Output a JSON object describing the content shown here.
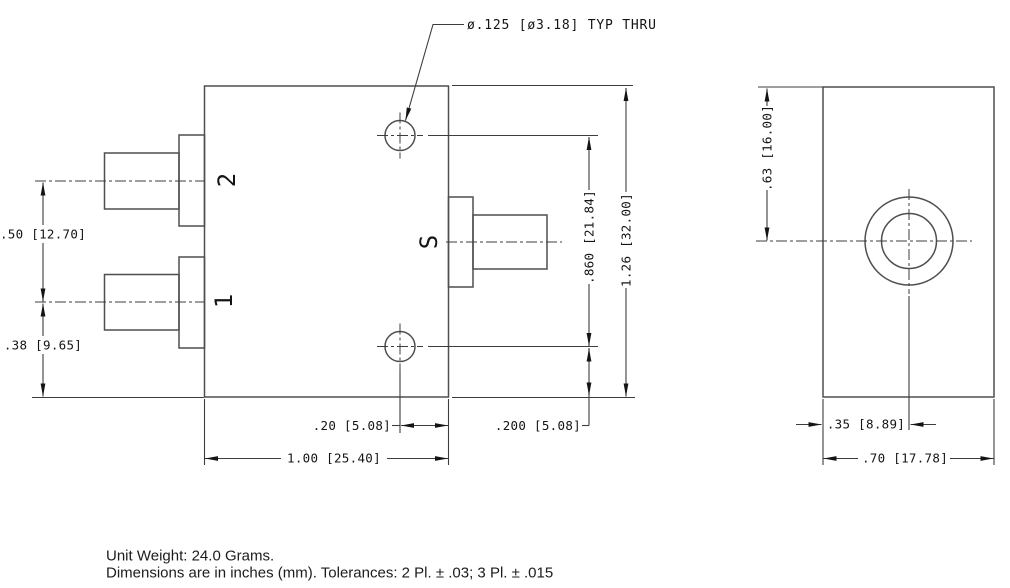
{
  "drawing": {
    "callout": "ø.125 [ø3.18] TYP THRU",
    "front": {
      "port2": "2",
      "port1": "1",
      "portS": "S",
      "dim_port_spacing": ".50 [12.70]",
      "dim_port1_to_bottom": ".38 [9.65]",
      "dim_hole_to_edge": ".20 [5.08]",
      "dim_hole_to_bottom": ".200 [5.08]",
      "dim_width": "1.00 [25.40]",
      "dim_hole_spacing": ".860 [21.84]",
      "dim_height": "1.26 [32.00]"
    },
    "side": {
      "dim_center_from_top": ".63 [16.00]",
      "dim_center_from_left": ".35 [8.89]",
      "dim_width": ".70 [17.78]"
    },
    "notes": {
      "line1": "Unit Weight: 24.0 Grams.",
      "line2": "Dimensions are in inches (mm). Tolerances: 2 Pl. ± .03; 3 Pl. ± .015"
    }
  }
}
